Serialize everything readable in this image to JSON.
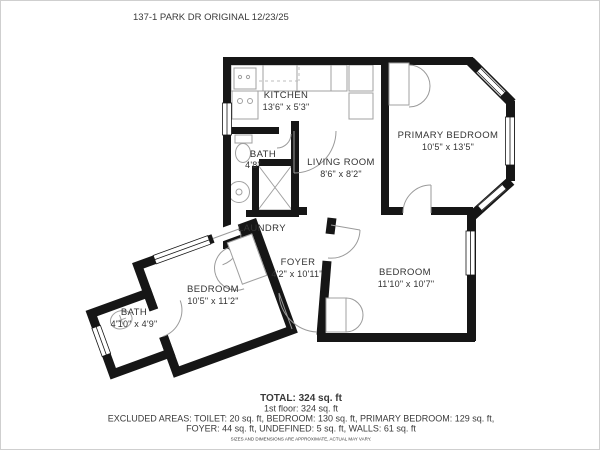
{
  "title": "137-1 PARK DR ORIGINAL 12/23/25",
  "rooms": {
    "kitchen": {
      "name": "KITCHEN",
      "dims": "13'6\" x 5'3\""
    },
    "bath_upper": {
      "name": "BATH",
      "dims": "4'8\""
    },
    "living_room": {
      "name": "LIVING ROOM",
      "dims": "8'6\" x 8'2\""
    },
    "primary_bedroom": {
      "name": "PRIMARY BEDROOM",
      "dims": "10'5\" x 13'5\""
    },
    "laundry": {
      "name": "LAUNDRY"
    },
    "foyer": {
      "name": "FOYER",
      "dims": "4'2\" x 10'11\""
    },
    "bedroom_right": {
      "name": "BEDROOM",
      "dims": "11'10\" x 10'7\""
    },
    "bedroom_left": {
      "name": "BEDROOM",
      "dims": "10'5\" x 11'2\""
    },
    "bath_lower": {
      "name": "BATH",
      "dims": "4'10\" x 4'9\""
    }
  },
  "summary": {
    "total": "TOTAL: 324 sq. ft",
    "floor": "1st floor: 324 sq. ft",
    "excluded_line1": "EXCLUDED AREAS: TOILET: 20 sq. ft, BEDROOM: 130 sq. ft, PRIMARY BEDROOM: 129 sq. ft,",
    "excluded_line2": "FOYER: 44 sq. ft, UNDEFINED: 5 sq. ft, WALLS: 61 sq. ft",
    "disclaimer": "SIZES AND DIMENSIONS ARE APPROXIMATE, ACTUAL MAY VARY."
  },
  "colors": {
    "wall": "#161616",
    "fixture": "#a0a0a0",
    "text": "#3a3a3a"
  }
}
